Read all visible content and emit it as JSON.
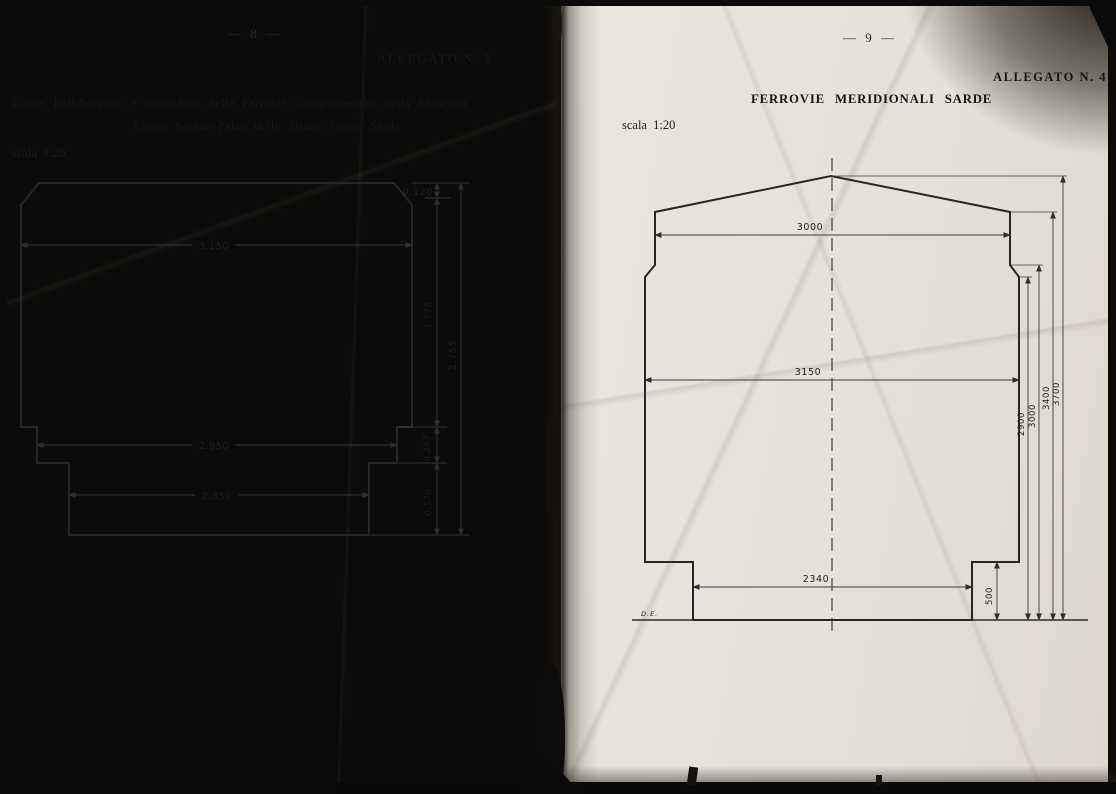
{
  "left": {
    "page_number": "— 8 —",
    "allegato": "ALLEGATO N. 3",
    "line1": "Linee: Isili-Sorgono e Nurri-Seui delle Ferrovie Complementari della Sardegna",
    "line2": "Linea: Sassari-Palau delle Strade Ferate Sarde",
    "scale": "scala 1:20",
    "diagram": {
      "width_top": "3.150",
      "width_mid": "2.950",
      "width_bottom": "2.350",
      "h_cant": "0.120",
      "h_upper": "1.778",
      "h_step": "0.287",
      "h_base": "0.570",
      "h_total": "2.755"
    }
  },
  "right": {
    "page_number": "— 9 —",
    "allegato": "ALLEGATO N. 4",
    "title": "FERROVIE MERIDIONALI SARDE",
    "scale": "scala 1:20",
    "signature": "D.E.",
    "diagram": {
      "width_top": "3000",
      "width_mid": "3150",
      "width_bottom": "2340",
      "h_foot": "500",
      "h1": "2900",
      "h2": "3000",
      "h3": "3400",
      "h4": "3700"
    }
  },
  "colors": {
    "paper": "#e7e5de",
    "ink": "#1d1d1d",
    "line": "#262626"
  }
}
